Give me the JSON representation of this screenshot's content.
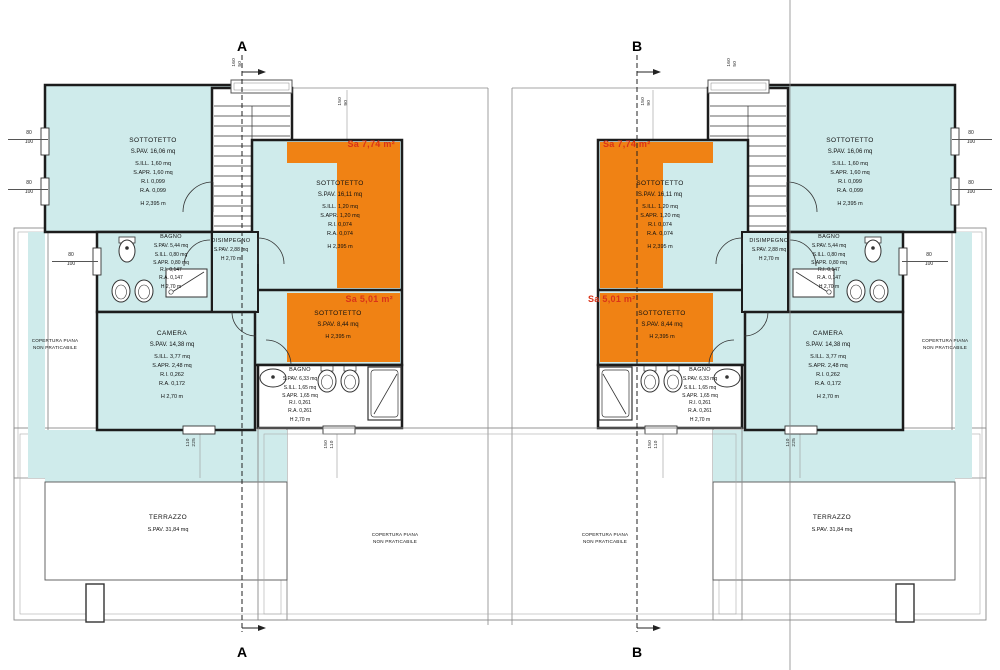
{
  "title": "floor plan - attic level, two mirrored units",
  "sections": {
    "a": "A",
    "b": "B"
  },
  "rooms": {
    "sottotetto_large": {
      "name": "SOTTOTETTO",
      "lines": [
        "S.PAV. 16,06 mq",
        "S.ILL. 1,60 mq",
        "S.APR. 1,60 mq",
        "R.I. 0,099",
        "R.A. 0,099",
        "H 2,395 m"
      ]
    },
    "sottotetto_center": {
      "name": "SOTTOTETTO",
      "lines": [
        "S.PAV. 16,11 mq",
        "S.ILL. 1,20 mq",
        "S.APR. 1,20 mq",
        "R.I. 0,074",
        "R.A. 0,074",
        "H 2,395 m"
      ]
    },
    "sottotetto_small": {
      "name": "SOTTOTETTO",
      "lines": [
        "S.PAV. 8,44 mq",
        "H 2,395 m"
      ]
    },
    "bagno_upper": {
      "name": "BAGNO",
      "lines": [
        "S.PAV. 5,44 mq",
        "S.ILL. 0,80 mq",
        "S.APR. 0,80 mq",
        "R.I. 0,147",
        "R.A. 0,147",
        "H 2,70 m"
      ]
    },
    "bagno_lower": {
      "name": "BAGNO",
      "lines": [
        "S.PAV. 6,33 mq",
        "S.ILL. 1,65 mq",
        "S.APR. 1,65 mq",
        "R.I. 0,261",
        "R.A. 0,261",
        "H 2,70 m"
      ]
    },
    "camera": {
      "name": "CAMERA",
      "lines": [
        "S.PAV. 14,38 mq",
        "S.ILL. 3,77 mq",
        "S.APR. 2,48 mq",
        "R.I. 0,262",
        "R.A. 0,172",
        "H 2,70 m"
      ]
    },
    "disimpegno": {
      "name": "DISIMPEGNO",
      "lines": [
        "S.PAV. 2,88 mq",
        "H 2,70 m"
      ]
    },
    "terrazzo": {
      "name": "TERRAZZO",
      "lines": [
        "S.PAV. 31,84 mq"
      ]
    }
  },
  "area_labels": {
    "sa_large": "Sa 7,74 m²",
    "sa_small": "Sa 5,01 m²"
  },
  "annotations": {
    "copertura_1": "COPERTURA PIANA",
    "copertura_2": "NON PRATICABILE"
  },
  "dims": {
    "w80": "80",
    "w100": "100",
    "v160": "160",
    "v50": "50",
    "v150": "150",
    "v90": "90",
    "v110": "110",
    "v225": "225"
  },
  "colors": {
    "room_fill": "#CFEBEB",
    "highlight_fill": "#F08214",
    "highlight_text": "#DA3318",
    "wall": "#1c1c1c"
  }
}
